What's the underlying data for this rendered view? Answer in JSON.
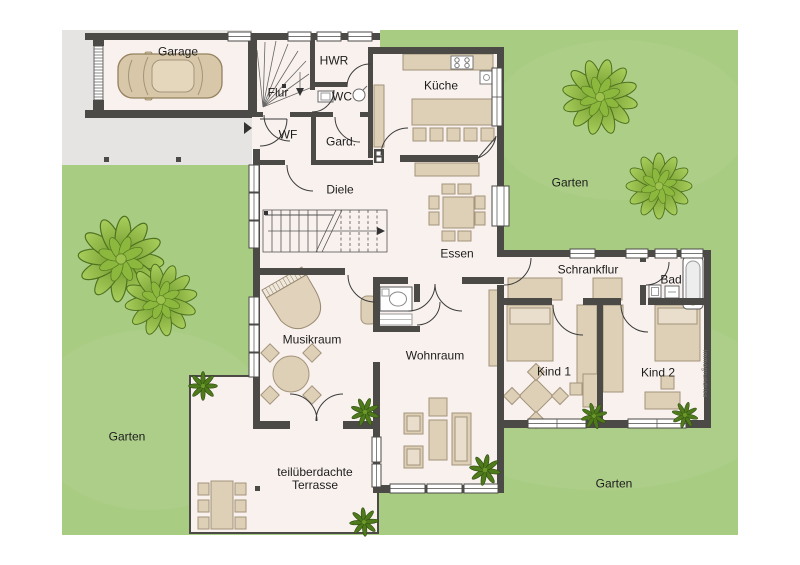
{
  "labels": {
    "garage": "Garage",
    "flur": "Flur",
    "hwr": "HWR",
    "wc": "WC",
    "kueche": "Küche",
    "wf": "WF",
    "gard": "Gard.",
    "diele": "Diele",
    "essen": "Essen",
    "schrankflur": "Schrankflur",
    "bad": "Bad",
    "musikraum": "Musikraum",
    "wohnraum": "Wohnraum",
    "kind1": "Kind 1",
    "kind2": "Kind 2",
    "terrasse_line1": "teilüberdachte",
    "terrasse_line2": "Terrasse",
    "garten_top": "Garten",
    "garten_left": "Garten",
    "garten_bottom": "Garten"
  },
  "watermark": "immogrundriss",
  "colors": {
    "garden": "#a9cc83",
    "wall": "#4b4a47",
    "floor": "#f9f1ee",
    "furniture": "#ddd0b6",
    "furniture_light": "#e9decb",
    "driveway": "#e5e4e2",
    "tree_dark": "#6c9629",
    "tree_light": "#a9ce5c"
  }
}
